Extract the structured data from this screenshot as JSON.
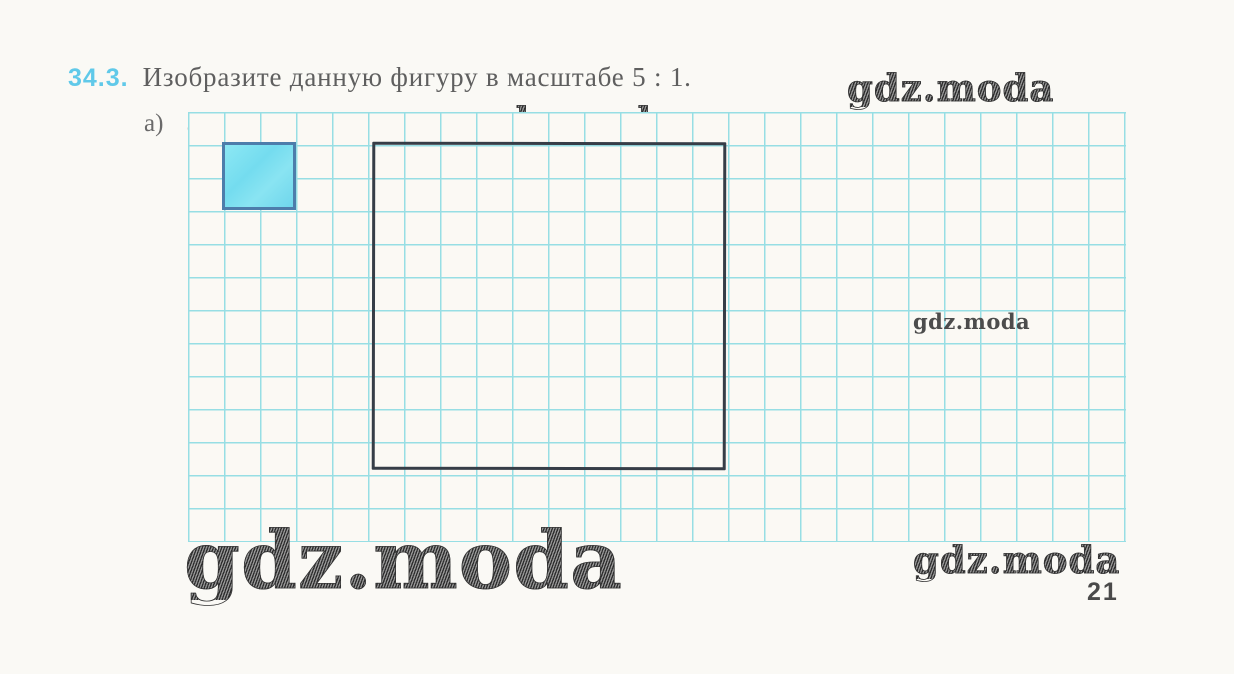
{
  "page": {
    "number": "21",
    "background_color": "#faf9f5"
  },
  "problem": {
    "number": "34.3.",
    "number_color": "#60c9e9",
    "statement": "Изобразите данную фигуру в масштабе 5 : 1.",
    "part_label": "а)"
  },
  "watermark": {
    "text": "gdz.moda"
  },
  "grid": {
    "line_color": "#97dee4",
    "cell_width_px": 36,
    "cell_height_px": 33,
    "columns": 26,
    "rows": 13
  },
  "figure": {
    "small_square_cells": "2x2",
    "small_square_fill": "#7de2f1",
    "small_square_border": "#4d7dab",
    "large_square_cells": "10x10",
    "large_square_border": "#363d47"
  }
}
